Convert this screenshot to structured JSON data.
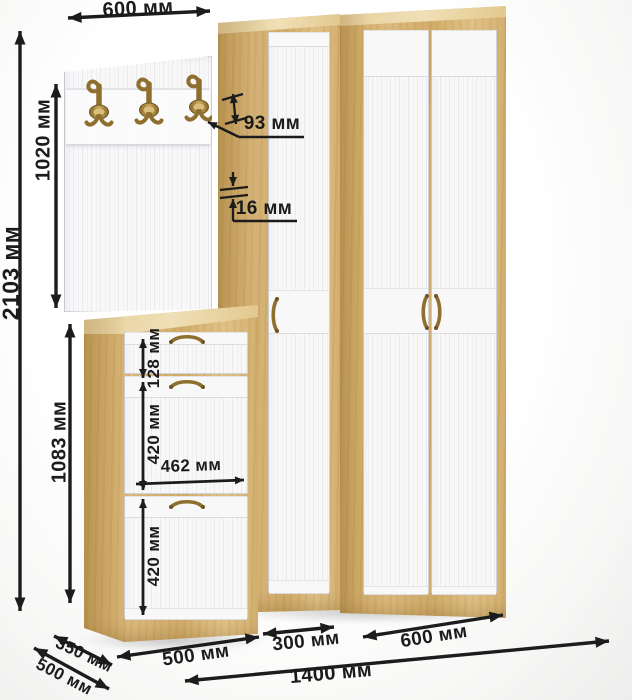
{
  "dims": {
    "panel_width": "600 мм",
    "total_height": "2103 мм",
    "panel_height": "1020 мм",
    "shoe_cabinet_height": "1083 мм",
    "hook_height": "93 мм",
    "panel_thickness": "16 мм",
    "drawer_height": "128 мм",
    "upper_compartment_height": "420 мм",
    "inner_width": "462 мм",
    "lower_compartment_height": "420 мм",
    "shoe_cabinet_depth": "350 мм",
    "total_depth": "500 мм",
    "shoe_cabinet_width": "500 мм",
    "narrow_wardrobe_width": "300 мм",
    "wide_wardrobe_width": "600 мм",
    "total_width": "1400 мм"
  },
  "colors": {
    "wood": "#d7b476",
    "wood_light": "#ecd9ae",
    "wood_dark": "#c49a58",
    "front_white": "#f8f8f9",
    "groove": "#dfdfe4",
    "brass": "#8f6f2e",
    "dimension_line": "#1c1c1c",
    "background": "#fbfbfa"
  }
}
